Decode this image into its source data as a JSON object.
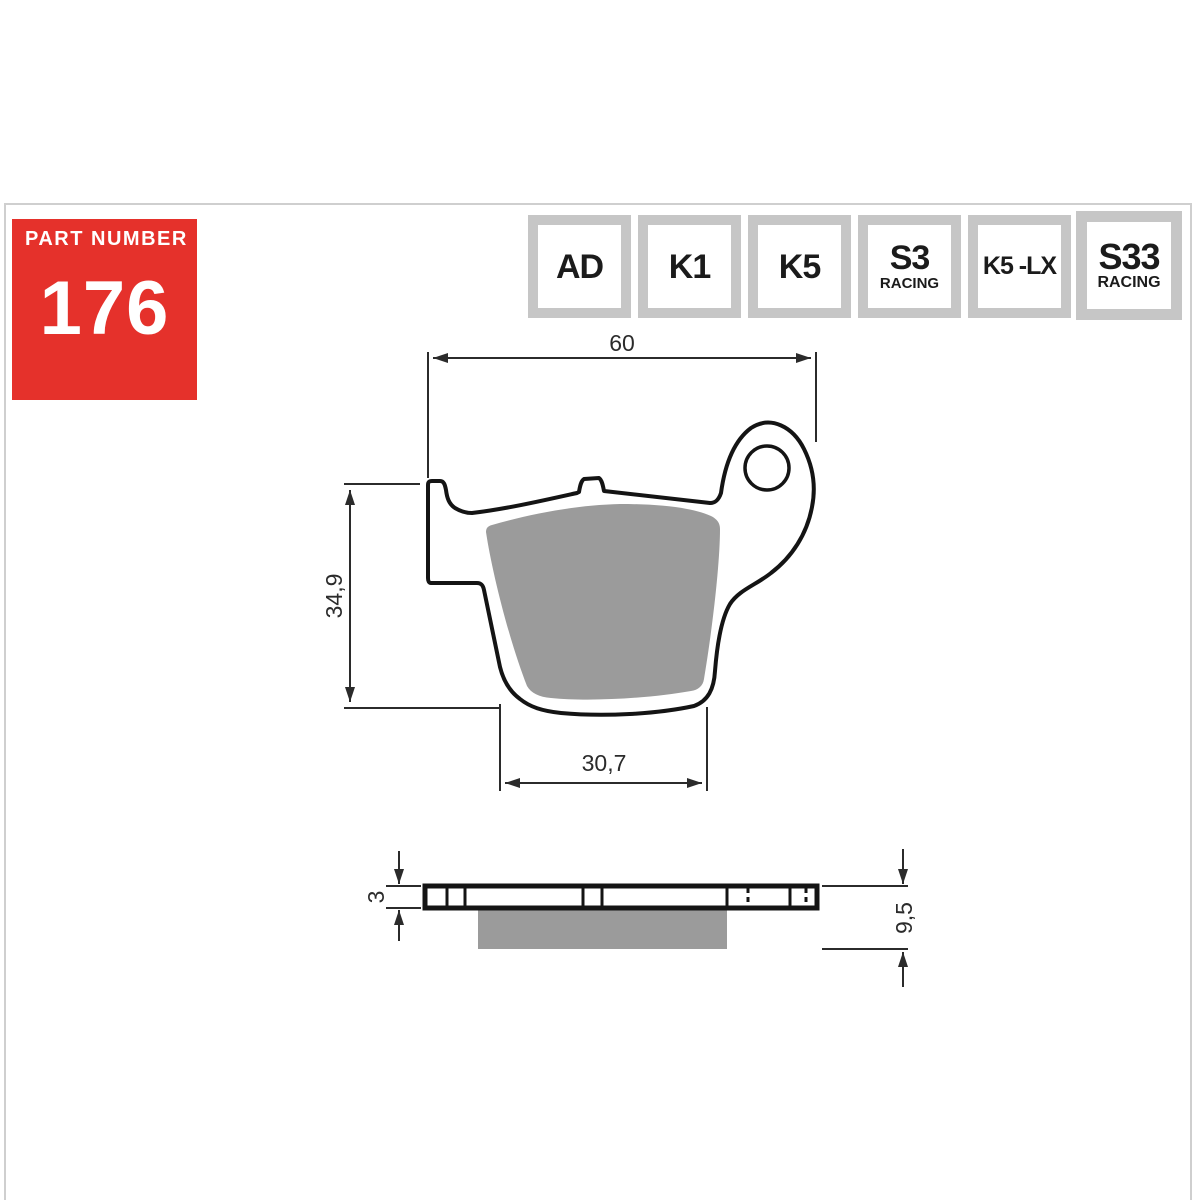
{
  "part_number": {
    "label": "PART NUMBER",
    "value": "176"
  },
  "compounds": [
    {
      "main": "AD"
    },
    {
      "main": "K1"
    },
    {
      "main": "K5"
    },
    {
      "main": "S3",
      "sub": "RACING"
    },
    {
      "main": "K5 -LX"
    },
    {
      "main": "S33",
      "sub": "RACING"
    }
  ],
  "dimensions": {
    "overall_width": "60",
    "overall_height": "34,9",
    "pad_width": "30,7",
    "plate_thickness": "3",
    "overall_thickness": "9,5"
  },
  "colors": {
    "accent_red": "#e5312b",
    "frame_gray": "#c6c6c6",
    "pad_gray": "#9b9b9b",
    "line_black": "#161616"
  }
}
